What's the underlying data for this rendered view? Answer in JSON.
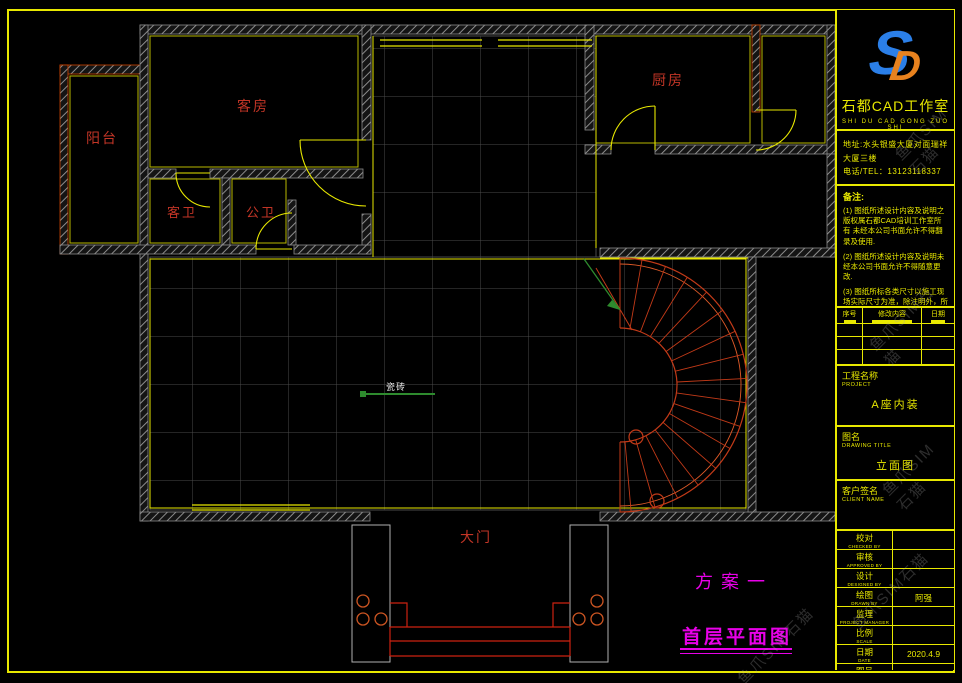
{
  "titleblock": {
    "logo": {
      "s": "S",
      "d": "D",
      "studio": "石都CAD工作室",
      "pinyin": "SHI DU CAD GONG ZUO SHI"
    },
    "address": {
      "line1": "地址:水头银盛大厦对面瑞祥",
      "line2": "大厦三楼",
      "line3": "电话/TEL：13123118337"
    },
    "notes": {
      "title": "备注:",
      "items": [
        "(1) 图纸所述设计内容及说明之版权属石都CAD培训工作室所有 未经本公司书面允许不得翻录及使用.",
        "(2) 图纸所述设计内容及说明未经本公司书面允许不得随意更改.",
        "(3) 图纸所标各类尺寸以施工现场实际尺寸为准，除注明外，所有尺寸均以毫米表示."
      ]
    },
    "revision": {
      "headers": [
        "序号",
        "修改内容",
        "日期"
      ]
    },
    "project": {
      "label": "工程名称",
      "sub": "PROJECT",
      "value": "A座内装"
    },
    "drawing": {
      "label": "图名",
      "sub": "DRAWING TITLE",
      "value": "立面图"
    },
    "client": {
      "label": "客户签名",
      "sub": "CLIENT NAME",
      "value": ""
    },
    "fields": [
      {
        "label": "校对",
        "sub": "CHECKED BY",
        "value": ""
      },
      {
        "label": "审核",
        "sub": "APPROVED BY",
        "value": ""
      },
      {
        "label": "设计",
        "sub": "DESIGNED BY",
        "value": ""
      },
      {
        "label": "绘图",
        "sub": "DRAWN BY",
        "value": "阿强"
      },
      {
        "label": "监理",
        "sub": "PROJECT MANAGER",
        "value": ""
      },
      {
        "label": "比例",
        "sub": "SCALE",
        "value": ""
      },
      {
        "label": "日期",
        "sub": "DATE",
        "value": "2020.4.9"
      },
      {
        "label": "图号",
        "sub": "DRAWING No",
        "value": "SD-05"
      }
    ]
  },
  "plan": {
    "rooms": {
      "balcony": "阳台",
      "guest_room": "客房",
      "guest_bath": "客卫",
      "public_bath": "公卫",
      "kitchen": "厨房",
      "main_gate": "大门"
    },
    "annotations": {
      "tile": "瓷砖",
      "scheme": "方案一",
      "plan_title": "首层平面图"
    }
  },
  "watermark": "鱼爪SIM石猫",
  "colors": {
    "frame_yellow": "#e8e800",
    "wall_gray": "#9a9a9a",
    "room_label_red": "#c23526",
    "stair_red": "#c23a18",
    "magenta": "#e800e8",
    "green": "#2e8b2e",
    "logo_blue": "#2b7fe8",
    "logo_orange": "#e8821e"
  }
}
